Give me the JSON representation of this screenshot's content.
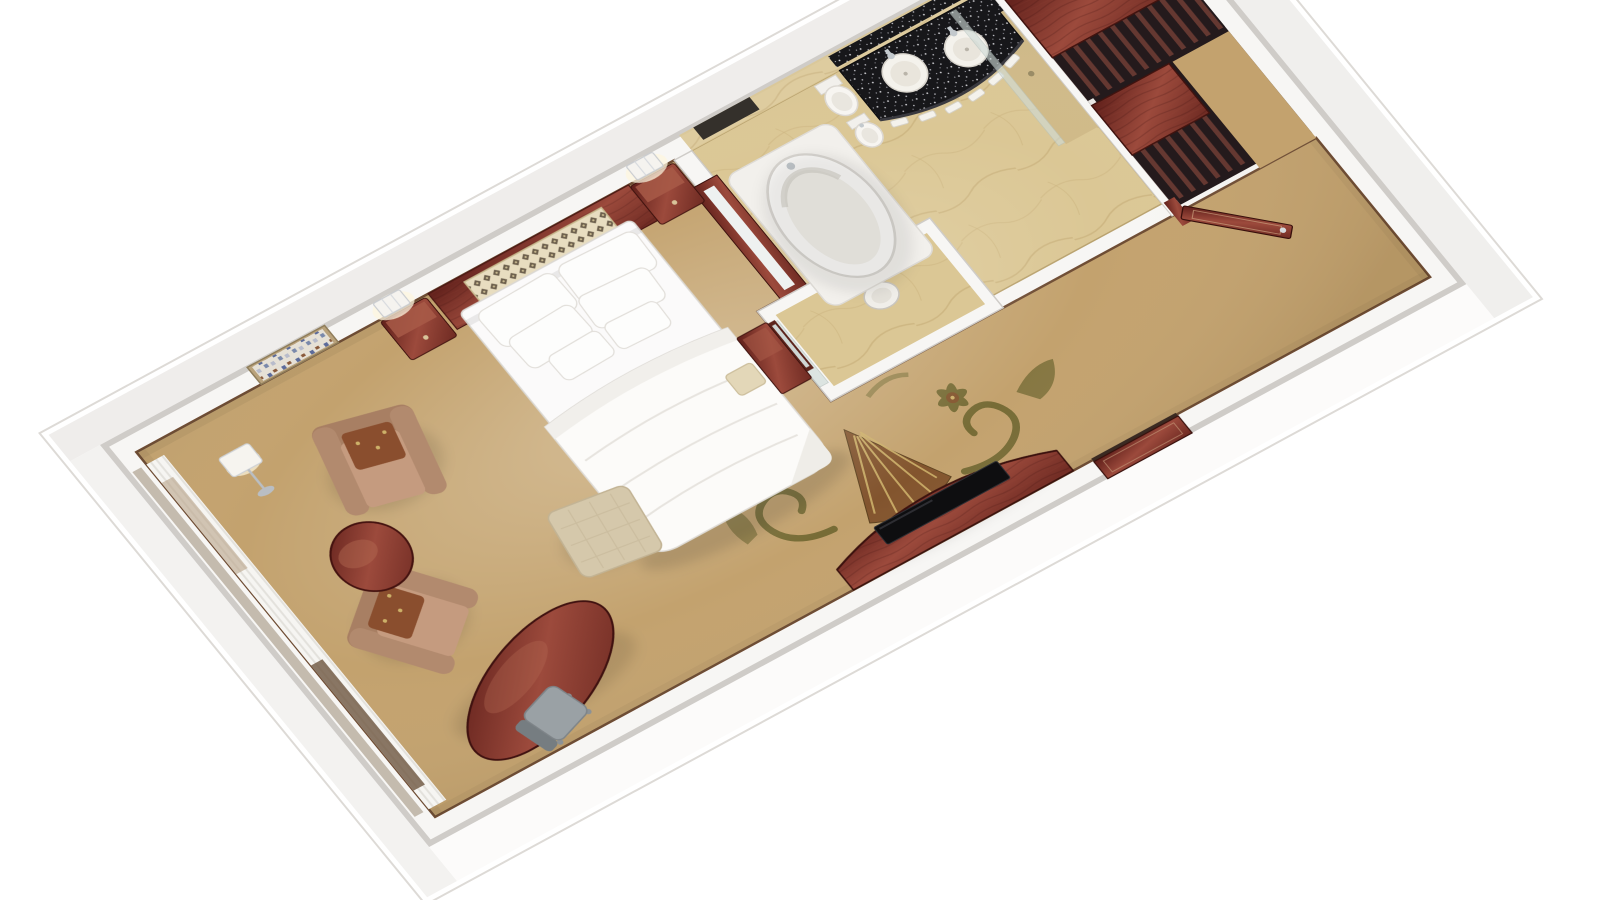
{
  "scene": {
    "kind": "3d-floor-plan-render",
    "description": "Isometric dollhouse render of a hotel guest room: bedroom with king bed, seating area and TV console; marble bathroom with twin-sink granite vanity, bathtub, WC and shower; mahogany wardrobes and entry door.",
    "background": "#ffffff",
    "objects": [
      "bedroom-floor-carpet",
      "carpet-ornament",
      "window-wall-curtains",
      "wall-art",
      "headboard",
      "bed",
      "pillows",
      "duvet",
      "nightstand-left",
      "nightstand-right",
      "sconce-left",
      "sconce-right",
      "floor-lamp",
      "armchair-upper",
      "armchair-lower",
      "round-side-table",
      "ottoman",
      "oval-work-table",
      "office-chair",
      "tv-console",
      "television",
      "connecting-door",
      "vanity-desk",
      "vanity-mirror",
      "vanity-stool",
      "bathroom-marble-floor",
      "bathtub",
      "toilet",
      "bidet",
      "granite-vanity-counter",
      "sink-left",
      "sink-right",
      "towel-shelf",
      "shower-glass",
      "shower-bench",
      "wc-room",
      "wc-glass-door",
      "wc-toilet",
      "wardrobe-top-a",
      "wardrobe-interior-a",
      "wardrobe-top-b",
      "wardrobe-interior-b",
      "decorative-panel",
      "entry-door",
      "entry-hall-floor"
    ]
  },
  "palette": {
    "background": "#ffffff",
    "wall_face": "#f7f6f4",
    "wall_cap": "#cfccc8",
    "outer_face_bright": "#fcfbfa",
    "outer_face_dim": "#efedeb",
    "carpet": "#c3a26e",
    "carpet_trim": "#6e4c33",
    "marble": "#dbc795",
    "marble_vein": "#c9b17c",
    "shower_floor": "#d0ba88",
    "wood_dark": "#5f1f1a",
    "wood_mid": "#9c4a3c",
    "wood_deep": "#6e2a22",
    "granite": "#17171a",
    "granite_speck": "#d9d9dd",
    "linen": "#fbfafa",
    "linen_line": "#dedbd6",
    "fixture_white": "#f2f0ec",
    "chair_tan": "#c59b7f",
    "chair_arm": "#b28a6e",
    "chair_back": "#a87f63",
    "cushion": "#8a4e2e",
    "ottoman": "#d5c8ab",
    "stool": "#e3d7b8",
    "glass": "#cfdbd7",
    "chrome": "#c3c9cd",
    "lamp_glow": "#fdf6df",
    "tv": "#0e0e10",
    "ornament_olive": "#6d652f",
    "ornament_brown": "#7a4a26",
    "ornament_gold": "#cdb169",
    "closet_void": "#241a1c",
    "closet_slat": "#653831",
    "lattice_cream": "#e8ddc0",
    "lattice_dot": "#4e4030",
    "red_panel": "#5a1d14",
    "gold_accent": "#c69a4e"
  }
}
